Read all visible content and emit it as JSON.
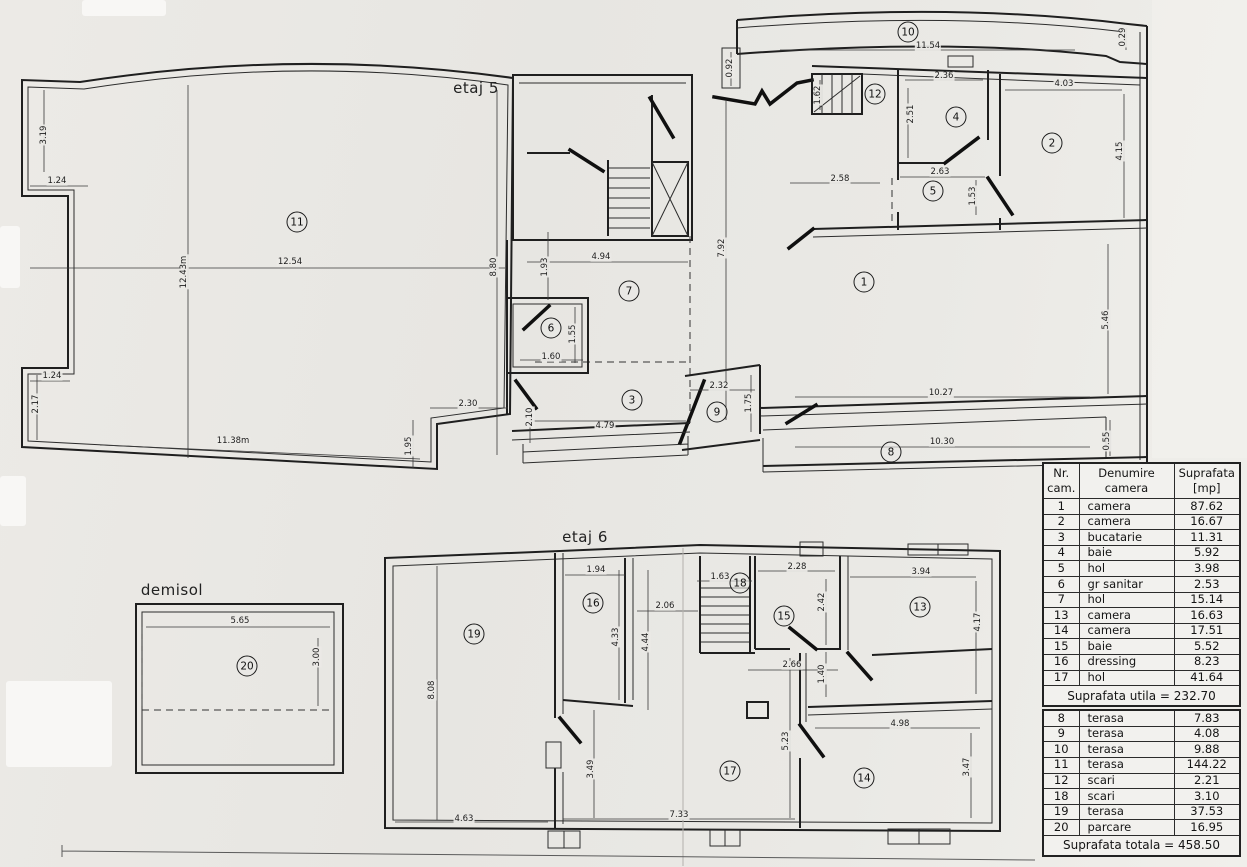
{
  "document": {
    "type_label": "scanned apartment floor plan",
    "colors": {
      "paper": "#e9e8e4",
      "ink": "#1f1f1f"
    }
  },
  "floor5": {
    "title": "etaj 5"
  },
  "floor6": {
    "title": "etaj 6"
  },
  "basement": {
    "title": "demisol"
  },
  "dimensions": [
    {
      "t": "3.19",
      "x": 44,
      "y": 135,
      "r": -90
    },
    {
      "t": "1.24",
      "x": 57,
      "y": 181
    },
    {
      "t": "12.54",
      "x": 290,
      "y": 262
    },
    {
      "t": "12.43m",
      "x": 184,
      "y": 272,
      "r": -90
    },
    {
      "t": "1.24",
      "x": 52,
      "y": 376
    },
    {
      "t": "2.17",
      "x": 36,
      "y": 404,
      "r": -90
    },
    {
      "t": "11.38m",
      "x": 233,
      "y": 441
    },
    {
      "t": "2.30",
      "x": 468,
      "y": 404
    },
    {
      "t": "1.95",
      "x": 409,
      "y": 446,
      "r": -90
    },
    {
      "t": "8.80",
      "x": 494,
      "y": 267,
      "r": -90
    },
    {
      "t": "1.93",
      "x": 545,
      "y": 267,
      "r": -90
    },
    {
      "t": "4.94",
      "x": 601,
      "y": 257
    },
    {
      "t": "7.92",
      "x": 722,
      "y": 248,
      "r": -90
    },
    {
      "t": "1.55",
      "x": 573,
      "y": 334,
      "r": -90
    },
    {
      "t": "1.60",
      "x": 551,
      "y": 357
    },
    {
      "t": "2.10",
      "x": 530,
      "y": 417,
      "r": -90
    },
    {
      "t": "4.79",
      "x": 605,
      "y": 426
    },
    {
      "t": "2.32",
      "x": 719,
      "y": 386
    },
    {
      "t": "1.75",
      "x": 749,
      "y": 403,
      "r": -90
    },
    {
      "t": "10.27",
      "x": 941,
      "y": 393
    },
    {
      "t": "10.30",
      "x": 942,
      "y": 442
    },
    {
      "t": "0.55",
      "x": 1107,
      "y": 441,
      "r": -90
    },
    {
      "t": "5.46",
      "x": 1106,
      "y": 320,
      "r": -90
    },
    {
      "t": "11.54",
      "x": 928,
      "y": 46
    },
    {
      "t": "0.92",
      "x": 730,
      "y": 68,
      "r": -90
    },
    {
      "t": "2.36",
      "x": 944,
      "y": 76
    },
    {
      "t": "2.51",
      "x": 911,
      "y": 114,
      "r": -90
    },
    {
      "t": "2.58",
      "x": 840,
      "y": 179
    },
    {
      "t": "2.63",
      "x": 940,
      "y": 172
    },
    {
      "t": "1.53",
      "x": 973,
      "y": 196,
      "r": -90
    },
    {
      "t": "4.03",
      "x": 1064,
      "y": 84
    },
    {
      "t": "4.15",
      "x": 1120,
      "y": 151,
      "r": -90
    },
    {
      "t": "0.29",
      "x": 1123,
      "y": 37,
      "r": -90
    },
    {
      "t": "1.62",
      "x": 818,
      "y": 95,
      "r": -90
    },
    {
      "t": "1.94",
      "x": 596,
      "y": 570
    },
    {
      "t": "1.63",
      "x": 720,
      "y": 577
    },
    {
      "t": "2.28",
      "x": 797,
      "y": 567
    },
    {
      "t": "3.94",
      "x": 921,
      "y": 572
    },
    {
      "t": "2.06",
      "x": 665,
      "y": 606
    },
    {
      "t": "2.42",
      "x": 822,
      "y": 602,
      "r": -90
    },
    {
      "t": "4.17",
      "x": 978,
      "y": 622,
      "r": -90
    },
    {
      "t": "4.33",
      "x": 616,
      "y": 637,
      "r": -90
    },
    {
      "t": "4.44",
      "x": 646,
      "y": 642,
      "r": -90
    },
    {
      "t": "8.08",
      "x": 432,
      "y": 690,
      "r": -90
    },
    {
      "t": "2.66",
      "x": 792,
      "y": 665
    },
    {
      "t": "1.40",
      "x": 822,
      "y": 674,
      "r": -90
    },
    {
      "t": "4.98",
      "x": 900,
      "y": 724
    },
    {
      "t": "3.47",
      "x": 967,
      "y": 767,
      "r": -90
    },
    {
      "t": "5.23",
      "x": 786,
      "y": 741,
      "r": -90
    },
    {
      "t": "3.49",
      "x": 591,
      "y": 769,
      "r": -90
    },
    {
      "t": "7.33",
      "x": 679,
      "y": 815
    },
    {
      "t": "4.63",
      "x": 464,
      "y": 819
    },
    {
      "t": "5.65",
      "x": 240,
      "y": 621
    },
    {
      "t": "3.00",
      "x": 317,
      "y": 657,
      "r": -90
    }
  ],
  "room_markers": [
    {
      "n": "11",
      "x": 297,
      "y": 222
    },
    {
      "n": "10",
      "x": 908,
      "y": 32
    },
    {
      "n": "12",
      "x": 875,
      "y": 94
    },
    {
      "n": "4",
      "x": 956,
      "y": 117
    },
    {
      "n": "5",
      "x": 933,
      "y": 191
    },
    {
      "n": "2",
      "x": 1052,
      "y": 143
    },
    {
      "n": "7",
      "x": 629,
      "y": 291
    },
    {
      "n": "1",
      "x": 864,
      "y": 282
    },
    {
      "n": "6",
      "x": 551,
      "y": 328
    },
    {
      "n": "3",
      "x": 632,
      "y": 400
    },
    {
      "n": "9",
      "x": 717,
      "y": 412
    },
    {
      "n": "8",
      "x": 891,
      "y": 452
    },
    {
      "n": "19",
      "x": 474,
      "y": 634
    },
    {
      "n": "16",
      "x": 593,
      "y": 603
    },
    {
      "n": "18",
      "x": 740,
      "y": 583
    },
    {
      "n": "15",
      "x": 784,
      "y": 616
    },
    {
      "n": "13",
      "x": 920,
      "y": 607
    },
    {
      "n": "17",
      "x": 730,
      "y": 771
    },
    {
      "n": "14",
      "x": 864,
      "y": 778
    },
    {
      "n": "20",
      "x": 247,
      "y": 666
    }
  ],
  "table": {
    "col_headers": [
      "Nr.\ncam.",
      "Denumire\ncamera",
      "Suprafata\n[mp]"
    ],
    "upper_rows": [
      [
        "1",
        "camera",
        "87.62"
      ],
      [
        "2",
        "camera",
        "16.67"
      ],
      [
        "3",
        "bucatarie",
        "11.31"
      ],
      [
        "4",
        "baie",
        "5.92"
      ],
      [
        "5",
        "hol",
        "3.98"
      ],
      [
        "6",
        "gr sanitar",
        "2.53"
      ],
      [
        "7",
        "hol",
        "15.14"
      ],
      [
        "13",
        "camera",
        "16.63"
      ],
      [
        "14",
        "camera",
        "17.51"
      ],
      [
        "15",
        "baie",
        "5.52"
      ],
      [
        "16",
        "dressing",
        "8.23"
      ],
      [
        "17",
        "hol",
        "41.64"
      ]
    ],
    "upper_summary": "Suprafata utila = 232.70",
    "lower_rows": [
      [
        "8",
        "terasa",
        "7.83"
      ],
      [
        "9",
        "terasa",
        "4.08"
      ],
      [
        "10",
        "terasa",
        "9.88"
      ],
      [
        "11",
        "terasa",
        "144.22"
      ],
      [
        "12",
        "scari",
        "2.21"
      ],
      [
        "18",
        "scari",
        "3.10"
      ],
      [
        "19",
        "terasa",
        "37.53"
      ],
      [
        "20",
        "parcare",
        "16.95"
      ]
    ],
    "lower_summary": "Suprafata totala = 458.50"
  }
}
